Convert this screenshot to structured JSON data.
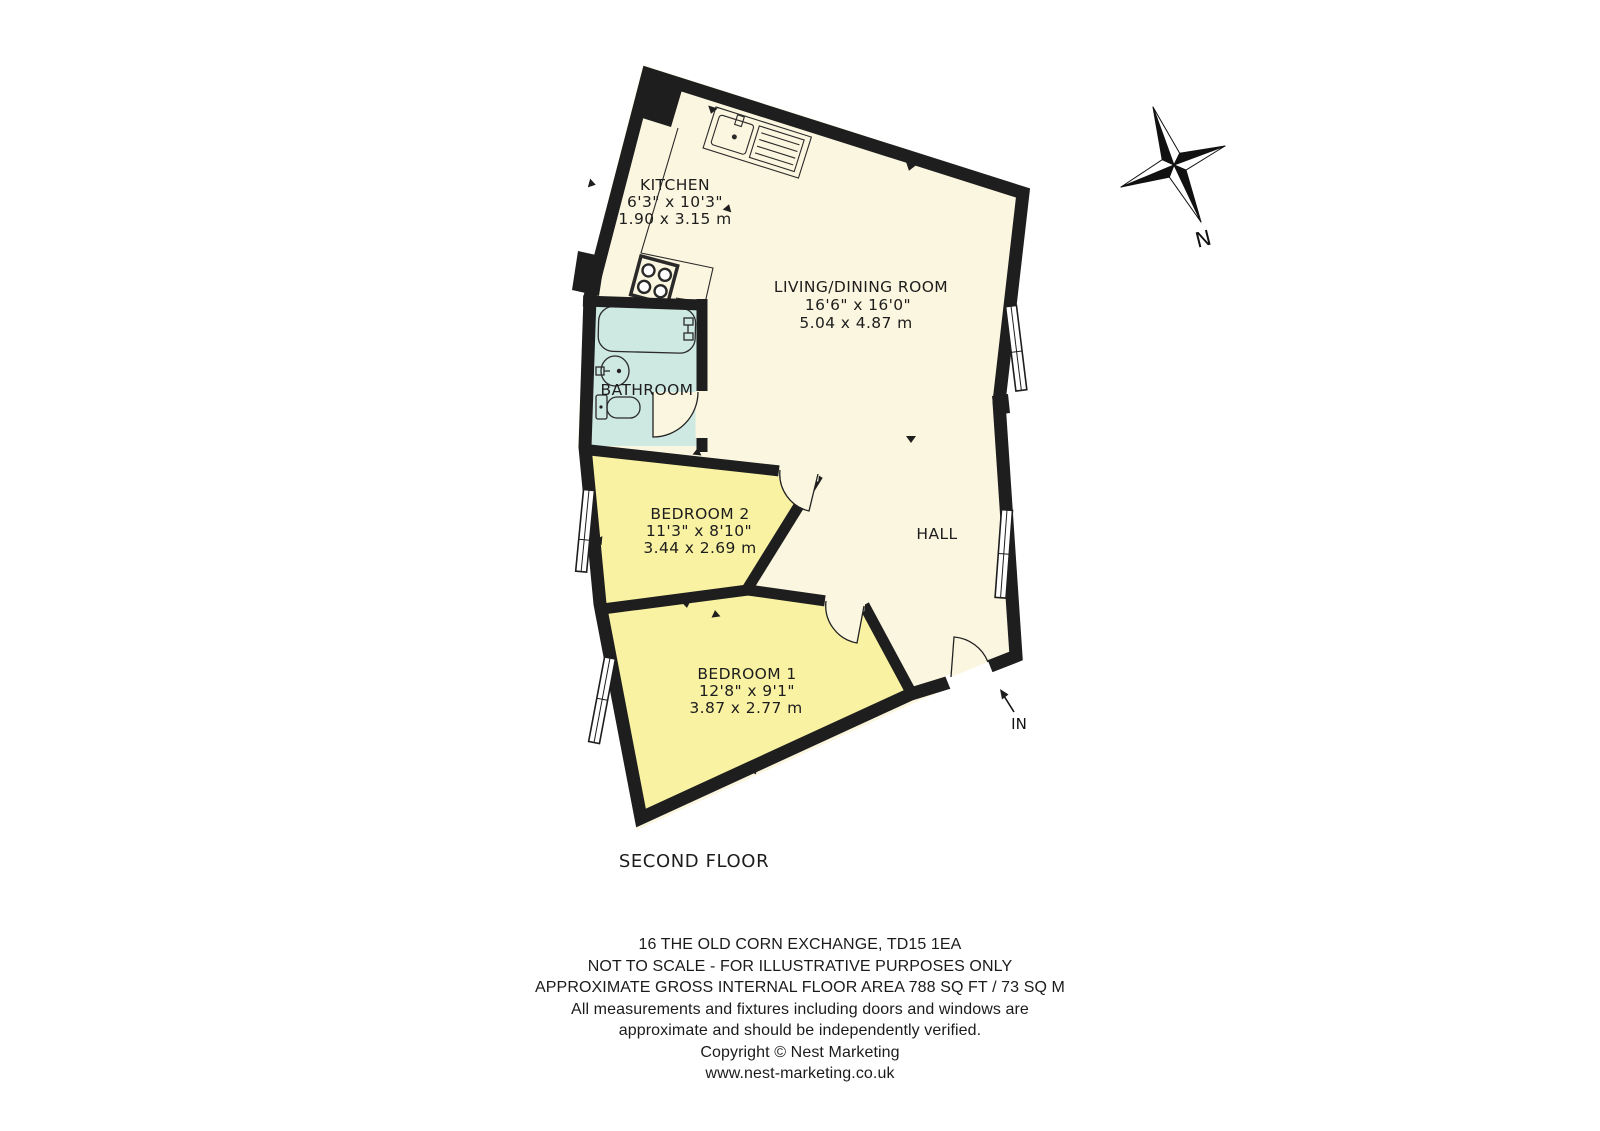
{
  "floor_plan": {
    "floor_label": "SECOND FLOOR",
    "compass_label": "N",
    "entrance_label": "IN",
    "rooms": [
      {
        "key": "kitchen",
        "name": "KITCHEN",
        "size_imperial": "6'3\" x 10'3\"",
        "size_metric": "1.90 x 3.15 m"
      },
      {
        "key": "living-dining-room",
        "name": "LIVING/DINING ROOM",
        "size_imperial": "16'6\" x 16'0\"",
        "size_metric": "5.04 x 4.87 m"
      },
      {
        "key": "bathroom",
        "name": "BATHROOM"
      },
      {
        "key": "bedroom-2",
        "name": "BEDROOM 2",
        "size_imperial": "11'3\" x 8'10\"",
        "size_metric": "3.44 x 2.69 m"
      },
      {
        "key": "bedroom-1",
        "name": "BEDROOM 1",
        "size_imperial": "12'8\" x 9'1\"",
        "size_metric": "3.87 x 2.77 m"
      },
      {
        "key": "hall",
        "name": "HALL"
      }
    ],
    "colors": {
      "wall": "#1E1E1E",
      "main_floor": "#FBF6DF",
      "bedroom_floor": "#F9F2A3",
      "bathroom_floor": "#CEE8E2"
    }
  },
  "footer": {
    "lines": [
      "16 THE OLD CORN EXCHANGE, TD15 1EA",
      "NOT TO SCALE - FOR ILLUSTRATIVE PURPOSES ONLY",
      "APPROXIMATE GROSS INTERNAL FLOOR AREA 788 SQ FT / 73 SQ M",
      "All measurements and fixtures including doors and windows are",
      "approximate and should be independently verified.",
      "Copyright © Nest Marketing",
      "www.nest-marketing.co.uk"
    ]
  }
}
